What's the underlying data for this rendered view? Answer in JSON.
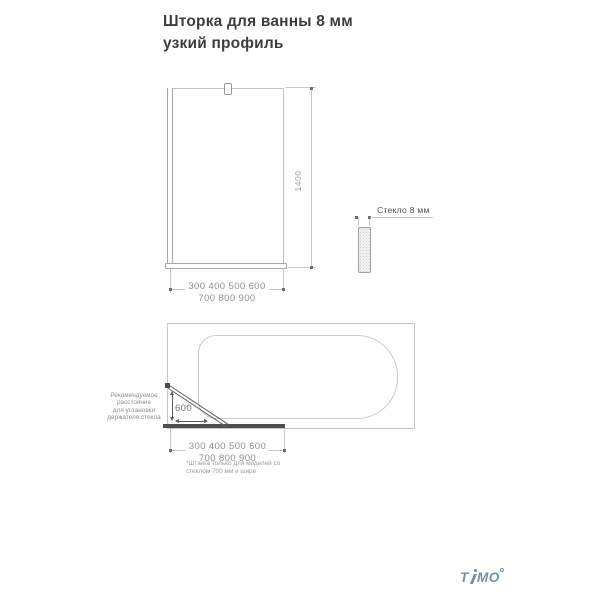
{
  "title": "Шторка для ванны 8 мм узкий профиль",
  "front_view": {
    "height_label": "1400",
    "width_row1": "300 400 500 600",
    "width_row2": "700 800 900"
  },
  "glass_detail": {
    "label": "Стекло 8 мм"
  },
  "plan_view": {
    "holder_note_lines": [
      "Рекомендуемое",
      "расстояние",
      "для установки",
      "держателя стекла"
    ],
    "distance_label": "600",
    "width_row1": "300 400 500 600",
    "width_row2": "700 800 900",
    "footnote_line1": "*Штанга только для моделей со",
    "footnote_line2": "стеклом 700 мм и шире"
  },
  "logo": {
    "text": "TIMO",
    "color": "#7291a6"
  },
  "colors": {
    "drawing_line": "#c6c6c6",
    "dark_element": "#4f4f4f",
    "dimension_text": "#8f8f8f",
    "title_text": "#3d3d3d"
  }
}
